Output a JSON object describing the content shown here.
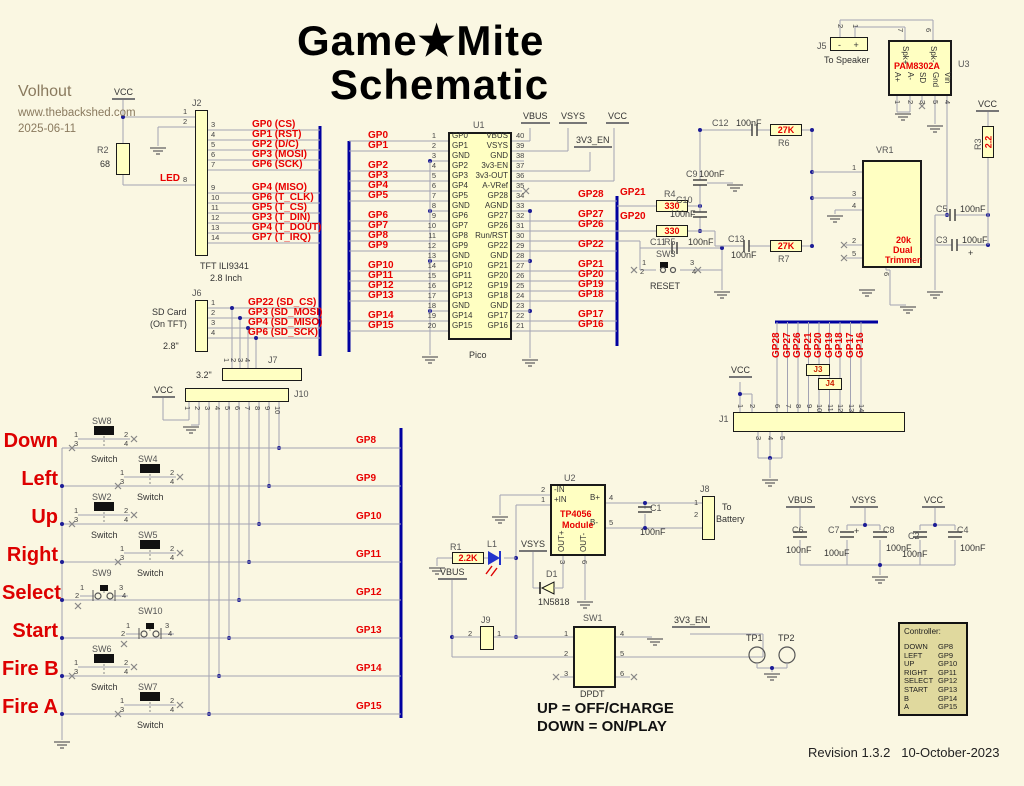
{
  "header": {
    "title_line1": "Game★Mite",
    "title_line2": "Schematic",
    "author": "Volhout",
    "website": "www.thebackshed.com",
    "date": "2025-06-11",
    "revision": "Revision 1.3.2   10-October-2023"
  },
  "notes": {
    "up": "UP = OFF/CHARGE",
    "down": "DOWN = ON/PLAY"
  },
  "controller": {
    "title": "Controller:",
    "rows": [
      {
        "button": "DOWN",
        "gpio": "GP8"
      },
      {
        "button": "LEFT",
        "gpio": "GP9"
      },
      {
        "button": "UP",
        "gpio": "GP10"
      },
      {
        "button": "RIGHT",
        "gpio": "GP11"
      },
      {
        "button": "SELECT",
        "gpio": "GP12"
      },
      {
        "button": "START",
        "gpio": "GP13"
      },
      {
        "button": "B",
        "gpio": "GP14"
      },
      {
        "button": "A",
        "gpio": "GP15"
      }
    ]
  },
  "pico": {
    "ref": "U1",
    "caption": "Pico",
    "left": [
      "GP0",
      "GP1",
      "GND",
      "GP2",
      "GP3",
      "GP4",
      "GP5",
      "GND",
      "GP6",
      "GP7",
      "GP8",
      "GP9",
      "GND",
      "GP10",
      "GP11",
      "GP12",
      "GP13",
      "GND",
      "GP14",
      "GP15"
    ],
    "right": [
      "VBUS",
      "VSYS",
      "GND",
      "3v3-EN",
      "3v3-OUT",
      "A-VRef",
      "GP28",
      "AGND",
      "GP27",
      "GP26",
      "Run/RST",
      "GP22",
      "GND",
      "GP21",
      "GP20",
      "GP19",
      "GP18",
      "GND",
      "GP17",
      "GP16"
    ],
    "nets_left": [
      {
        "p": 1,
        "t": "GP0"
      },
      {
        "p": 2,
        "t": "GP1"
      },
      {
        "p": 4,
        "t": "GP2"
      },
      {
        "p": 5,
        "t": "GP3"
      },
      {
        "p": 6,
        "t": "GP4"
      },
      {
        "p": 7,
        "t": "GP5"
      },
      {
        "p": 9,
        "t": "GP6"
      },
      {
        "p": 10,
        "t": "GP7"
      },
      {
        "p": 11,
        "t": "GP8"
      },
      {
        "p": 12,
        "t": "GP9"
      },
      {
        "p": 14,
        "t": "GP10"
      },
      {
        "p": 15,
        "t": "GP11"
      },
      {
        "p": 16,
        "t": "GP12"
      },
      {
        "p": 17,
        "t": "GP13"
      },
      {
        "p": 19,
        "t": "GP14"
      },
      {
        "p": 20,
        "t": "GP15"
      }
    ],
    "nets_right": [
      {
        "p": 34,
        "t": "GP28"
      },
      {
        "p": 32,
        "t": "GP27"
      },
      {
        "p": 31,
        "t": "GP26"
      },
      {
        "p": 29,
        "t": "GP22"
      },
      {
        "p": 27,
        "t": "GP21"
      },
      {
        "p": 26,
        "t": "GP20"
      },
      {
        "p": 25,
        "t": "GP19"
      },
      {
        "p": 24,
        "t": "GP18"
      },
      {
        "p": 22,
        "t": "GP17"
      },
      {
        "p": 21,
        "t": "GP16"
      }
    ]
  },
  "j2": {
    "ref": "J2",
    "pins_left": [
      {
        "t": "1",
        "y": 117
      },
      {
        "t": "2",
        "y": 127
      },
      {
        "t": "8",
        "y": 185
      }
    ],
    "pins": [
      {
        "n": "3",
        "net": "GP0 (CS)",
        "y": 130
      },
      {
        "n": "4",
        "net": "GP1 (RST)",
        "y": 140
      },
      {
        "n": "5",
        "net": "GP2 (D/C)",
        "y": 150
      },
      {
        "n": "6",
        "net": "GP3 (MOSI)",
        "y": 160
      },
      {
        "n": "7",
        "net": "GP6 (SCK)",
        "y": 170
      },
      {
        "n": "9",
        "net": "GP4 (MISO)",
        "y": 193
      },
      {
        "n": "10",
        "net": "GP6 (T_CLK)",
        "y": 203
      },
      {
        "n": "11",
        "net": "GP5 (T_CS)",
        "y": 213
      },
      {
        "n": "12",
        "net": "GP3 (T_DIN)",
        "y": 223
      },
      {
        "n": "13",
        "net": "GP4 (T_DOUT)",
        "y": 233
      },
      {
        "n": "14",
        "net": "GP7 (T_IRQ)",
        "y": 243
      }
    ]
  },
  "j6": {
    "ref": "J6",
    "pins": [
      {
        "n": "1",
        "net": "GP22 (SD_CS)",
        "y": 308
      },
      {
        "n": "2",
        "net": "GP3 (SD_MOSI)",
        "y": 318
      },
      {
        "n": "3",
        "net": "GP4 (SD_MISO)",
        "y": 328
      },
      {
        "n": "4",
        "net": "GP6 (SD_SCK)",
        "y": 338
      }
    ]
  },
  "j7": {
    "ref": "J7",
    "pins": [
      "1",
      "2",
      "3",
      "4"
    ]
  },
  "j10": {
    "ref": "J10",
    "pins": [
      "1",
      "2",
      "3",
      "4",
      "5",
      "6",
      "7",
      "8",
      "9",
      "10"
    ]
  },
  "buttons": {
    "pin_numbers": [
      "1",
      "2",
      "3",
      "4"
    ],
    "caption": "Switch",
    "rows": [
      {
        "label": "Down",
        "sw": "SW8",
        "net": "GP8",
        "type": "A",
        "cx": 104,
        "row": 448
      },
      {
        "label": "Left",
        "sw": "SW4",
        "net": "GP9",
        "type": "A",
        "cx": 150,
        "row": 486
      },
      {
        "label": "Up",
        "sw": "SW2",
        "net": "GP10",
        "type": "A",
        "cx": 104,
        "row": 524
      },
      {
        "label": "Right",
        "sw": "SW5",
        "net": "GP11",
        "type": "A",
        "cx": 150,
        "row": 562
      },
      {
        "label": "Select",
        "sw": "SW9",
        "net": "GP12",
        "type": "B",
        "cx": 104,
        "row": 600
      },
      {
        "label": "Start",
        "sw": "SW10",
        "net": "GP13",
        "type": "B",
        "cx": 150,
        "row": 638
      },
      {
        "label": "Fire B",
        "sw": "SW6",
        "net": "GP14",
        "type": "A",
        "cx": 104,
        "row": 676
      },
      {
        "label": "Fire A",
        "sw": "SW7",
        "net": "GP15",
        "type": "A",
        "cx": 150,
        "row": 714
      }
    ]
  },
  "j1": {
    "ref": "J1",
    "nets": [
      "GP28",
      "GP27",
      "GP26",
      "GP21",
      "GP20",
      "GP19",
      "GP18",
      "GP17",
      "GP16"
    ],
    "top_pins": [
      "6",
      "7",
      "8",
      "9",
      "10",
      "11",
      "12",
      "13",
      "14"
    ],
    "left_pins": [
      "1",
      "2"
    ],
    "bottom_pins": [
      "3",
      "4",
      "5"
    ],
    "jumpers": [
      "J3",
      "J4"
    ]
  },
  "u2": {
    "ref": "U2",
    "part1": "TP4056",
    "part2": "Module",
    "left": [
      {
        "t": "-IN",
        "n": "2",
        "y": 495
      },
      {
        "t": "+IN",
        "n": "1",
        "y": 505
      }
    ],
    "right": [
      {
        "t": "B+",
        "n": "4",
        "y": 503
      },
      {
        "t": "B-",
        "n": "5",
        "y": 528
      }
    ],
    "bottom": [
      {
        "t": "OUT+",
        "n": "3",
        "x": 563
      },
      {
        "t": "OUT-",
        "n": "6",
        "x": 585
      }
    ]
  },
  "u3": {
    "ref": "U3",
    "part": "PAM8302A",
    "top": [
      {
        "t": "Spk+",
        "n": "7",
        "x": 905
      },
      {
        "t": "Spk-",
        "n": "6",
        "x": 933
      }
    ],
    "bottom": [
      {
        "t": "A+",
        "n": "1",
        "x": 897
      },
      {
        "t": "A-",
        "n": "2",
        "x": 910
      },
      {
        "t": "SD",
        "n": "3",
        "x": 922
      },
      {
        "t": "Gnd",
        "n": "5",
        "x": 935
      },
      {
        "t": "Vin",
        "n": "4",
        "x": 947
      }
    ]
  },
  "sw1": {
    "ref": "SW1",
    "left": [
      "1",
      "2",
      "3"
    ],
    "right": [
      "4",
      "5",
      "6"
    ],
    "caption": "DPDT"
  },
  "resistors": [
    {
      "name": "r2-body",
      "x": 116,
      "y": 143,
      "w": 14,
      "h": 32,
      "val": ""
    },
    {
      "name": "r4-body",
      "x": 656,
      "y": 200,
      "w": 32,
      "h": 12,
      "val": "330"
    },
    {
      "name": "r5-body",
      "x": 656,
      "y": 225,
      "w": 32,
      "h": 12,
      "val": "330"
    },
    {
      "name": "r6-body",
      "x": 770,
      "y": 124,
      "w": 32,
      "h": 12,
      "val": "27K"
    },
    {
      "name": "r7-body",
      "x": 770,
      "y": 240,
      "w": 32,
      "h": 12,
      "val": "27K"
    },
    {
      "name": "r1-body",
      "x": 452,
      "y": 552,
      "w": 32,
      "h": 12,
      "val": "2.2K"
    },
    {
      "name": "r3-body",
      "x": 982,
      "y": 126,
      "w": 12,
      "h": 32,
      "val": "2.2",
      "vert": true
    }
  ],
  "labels": [
    {
      "n": "vcc-tft",
      "t": "VCC",
      "c": "pwr",
      "x": 112,
      "y": 88
    },
    {
      "n": "r2-ref",
      "t": "R2",
      "c": "des",
      "x": 97,
      "y": 146
    },
    {
      "n": "r2-val",
      "t": "68",
      "c": "val",
      "x": 100,
      "y": 160
    },
    {
      "n": "led-net",
      "t": "LED",
      "c": "net",
      "x": 160,
      "y": 174
    },
    {
      "n": "j2-ref",
      "t": "J2",
      "c": "des",
      "x": 192,
      "y": 99
    },
    {
      "n": "tft-cap1",
      "t": "TFT ILI9341",
      "c": "cap",
      "x": 200,
      "y": 262
    },
    {
      "n": "tft-cap2",
      "t": "2.8 Inch",
      "c": "cap",
      "x": 210,
      "y": 274
    },
    {
      "n": "j6-ref",
      "t": "J6",
      "c": "des",
      "x": 192,
      "y": 289
    },
    {
      "n": "sd-cap1",
      "t": "SD Card",
      "c": "cap",
      "x": 152,
      "y": 308
    },
    {
      "n": "sd-cap2",
      "t": "(On TFT)",
      "c": "cap",
      "x": 150,
      "y": 320
    },
    {
      "n": "sd-size1",
      "t": "2.8\"",
      "c": "cap",
      "x": 163,
      "y": 342
    },
    {
      "n": "sd-size2",
      "t": "3.2\"",
      "c": "cap",
      "x": 196,
      "y": 371
    },
    {
      "n": "j7-ref",
      "t": "J7",
      "c": "des",
      "x": 268,
      "y": 356
    },
    {
      "n": "j10-ref",
      "t": "J10",
      "c": "des",
      "x": 294,
      "y": 390
    },
    {
      "n": "vcc-j10",
      "t": "VCC",
      "c": "pwr",
      "x": 152,
      "y": 386
    },
    {
      "n": "u1-ref",
      "t": "U1",
      "c": "des",
      "x": 473,
      "y": 121
    },
    {
      "n": "u1-cap",
      "t": "Pico",
      "c": "cap",
      "x": 469,
      "y": 351
    },
    {
      "n": "vbus-pico",
      "t": "VBUS",
      "c": "pwr",
      "x": 521,
      "y": 112
    },
    {
      "n": "vsys-pico",
      "t": "VSYS",
      "c": "pwr",
      "x": 559,
      "y": 112
    },
    {
      "n": "vcc-pico",
      "t": "VCC",
      "c": "pwr",
      "x": 606,
      "y": 112
    },
    {
      "n": "en-pico",
      "t": "3V3_EN",
      "c": "pwr",
      "x": 574,
      "y": 136
    },
    {
      "n": "gp21-net",
      "t": "GP21",
      "c": "net",
      "x": 620,
      "y": 188
    },
    {
      "n": "gp20-net",
      "t": "GP20",
      "c": "net",
      "x": 620,
      "y": 212
    },
    {
      "n": "r4-ref",
      "t": "R4",
      "c": "des",
      "x": 664,
      "y": 190
    },
    {
      "n": "r5-ref",
      "t": "R5",
      "c": "des",
      "x": 664,
      "y": 238
    },
    {
      "n": "c9-ref",
      "t": "C9",
      "c": "des",
      "x": 686,
      "y": 170
    },
    {
      "n": "c9-val",
      "t": "100nF",
      "c": "val",
      "x": 699,
      "y": 170
    },
    {
      "n": "c10-ref",
      "t": "C10",
      "c": "des",
      "x": 676,
      "y": 196
    },
    {
      "n": "c10-val",
      "t": "100nF",
      "c": "val",
      "x": 670,
      "y": 210
    },
    {
      "n": "c12-ref",
      "t": "C12",
      "c": "des",
      "x": 712,
      "y": 119
    },
    {
      "n": "c12-val",
      "t": "100nF",
      "c": "val",
      "x": 736,
      "y": 119
    },
    {
      "n": "r6-ref",
      "t": "R6",
      "c": "des",
      "x": 778,
      "y": 139
    },
    {
      "n": "c13-ref",
      "t": "C13",
      "c": "des",
      "x": 728,
      "y": 235
    },
    {
      "n": "c13-val",
      "t": "100nF",
      "c": "val",
      "x": 731,
      "y": 251
    },
    {
      "n": "r7-ref",
      "t": "R7",
      "c": "des",
      "x": 778,
      "y": 255
    },
    {
      "n": "c11-ref",
      "t": "C11",
      "c": "des",
      "x": 650,
      "y": 238
    },
    {
      "n": "c11-val",
      "t": "100nF",
      "c": "val",
      "x": 688,
      "y": 238
    },
    {
      "n": "sw3-ref",
      "t": "SW3",
      "c": "des",
      "x": 656,
      "y": 250
    },
    {
      "n": "sw3-p1",
      "t": "1",
      "c": "pin",
      "x": 642,
      "y": 259
    },
    {
      "n": "sw3-p2",
      "t": "2",
      "c": "pin",
      "x": 640,
      "y": 268
    },
    {
      "n": "sw3-p3",
      "t": "3",
      "c": "pin",
      "x": 690,
      "y": 259
    },
    {
      "n": "sw3-p4",
      "t": "4",
      "c": "pin",
      "x": 692,
      "y": 268
    },
    {
      "n": "sw3-cap",
      "t": "RESET",
      "c": "cap",
      "x": 650,
      "y": 282
    },
    {
      "n": "vr1-ref",
      "t": "VR1",
      "c": "des",
      "x": 876,
      "y": 146
    },
    {
      "n": "vr1-p1",
      "t": "1",
      "c": "pin",
      "x": 852,
      "y": 164
    },
    {
      "n": "vr1-p3",
      "t": "3",
      "c": "pin",
      "x": 852,
      "y": 190
    },
    {
      "n": "vr1-p4",
      "t": "4",
      "c": "pin",
      "x": 852,
      "y": 202
    },
    {
      "n": "vr1-p2",
      "t": "2",
      "c": "pin",
      "x": 852,
      "y": 237
    },
    {
      "n": "vr1-p5",
      "t": "5",
      "c": "pin",
      "x": 852,
      "y": 250
    },
    {
      "n": "vr1-p6",
      "t": "6",
      "c": "pin",
      "x": 890,
      "y": 272,
      "r": 90
    },
    {
      "n": "vr1-val1",
      "t": "20k",
      "c": "rlbl",
      "x": 896,
      "y": 236
    },
    {
      "n": "vr1-val2",
      "t": "Dual",
      "c": "rlbl",
      "x": 893,
      "y": 246
    },
    {
      "n": "vr1-val3",
      "t": "Trimmer",
      "c": "rlbl",
      "x": 885,
      "y": 256
    },
    {
      "n": "j5-ref",
      "t": "J5",
      "c": "des",
      "x": 817,
      "y": 42
    },
    {
      "n": "j5-pol",
      "t": "-     +",
      "c": "val",
      "x": 838,
      "y": 41
    },
    {
      "n": "j5-p2",
      "t": "2",
      "c": "pin",
      "x": 844,
      "y": 24,
      "r": 90
    },
    {
      "n": "j5-p1",
      "t": "1",
      "c": "pin",
      "x": 859,
      "y": 24,
      "r": 90
    },
    {
      "n": "j5-cap",
      "t": "To Speaker",
      "c": "cap",
      "x": 824,
      "y": 56
    },
    {
      "n": "u3-ref",
      "t": "U3",
      "c": "des",
      "x": 958,
      "y": 60
    },
    {
      "n": "u3-part",
      "t": "PAM8302A",
      "c": "rlbl",
      "x": 894,
      "y": 62
    },
    {
      "n": "vcc-r3",
      "t": "VCC",
      "c": "pwr",
      "x": 976,
      "y": 100
    },
    {
      "n": "r3-ref",
      "t": "R3",
      "c": "des",
      "x": 974,
      "y": 150,
      "r": -90
    },
    {
      "n": "c5-ref",
      "t": "C5",
      "c": "des",
      "x": 936,
      "y": 205
    },
    {
      "n": "c5-val",
      "t": "100nF",
      "c": "val",
      "x": 960,
      "y": 205
    },
    {
      "n": "c3-ref",
      "t": "C3",
      "c": "des",
      "x": 936,
      "y": 236
    },
    {
      "n": "c3-val",
      "t": "100uF",
      "c": "val",
      "x": 962,
      "y": 236
    },
    {
      "n": "c3-plus",
      "t": "+",
      "c": "val",
      "x": 968,
      "y": 249
    },
    {
      "n": "u2-ref",
      "t": "U2",
      "c": "des",
      "x": 564,
      "y": 474
    },
    {
      "n": "c1-ref",
      "t": "C1",
      "c": "des",
      "x": 650,
      "y": 504
    },
    {
      "n": "c1-val",
      "t": "100nF",
      "c": "val",
      "x": 640,
      "y": 528
    },
    {
      "n": "j8-ref",
      "t": "J8",
      "c": "des",
      "x": 700,
      "y": 485
    },
    {
      "n": "j8-p1",
      "t": "1",
      "c": "pin",
      "x": 694,
      "y": 499
    },
    {
      "n": "j8-p2",
      "t": "2",
      "c": "pin",
      "x": 694,
      "y": 511
    },
    {
      "n": "j8-cap1",
      "t": "To",
      "c": "cap",
      "x": 722,
      "y": 503
    },
    {
      "n": "j8-cap2",
      "t": "Battery",
      "c": "cap",
      "x": 716,
      "y": 515
    },
    {
      "n": "r1-ref",
      "t": "R1",
      "c": "des",
      "x": 450,
      "y": 543
    },
    {
      "n": "l1-ref",
      "t": "L1",
      "c": "des",
      "x": 487,
      "y": 540
    },
    {
      "n": "vsys-d1",
      "t": "VSYS",
      "c": "pwr",
      "x": 519,
      "y": 540
    },
    {
      "n": "d1-ref",
      "t": "D1",
      "c": "des",
      "x": 546,
      "y": 570
    },
    {
      "n": "d1-val",
      "t": "1N5818",
      "c": "cap",
      "x": 538,
      "y": 598
    },
    {
      "n": "vbus-l",
      "t": "VBUS",
      "c": "pwr",
      "x": 438,
      "y": 568
    },
    {
      "n": "j9-ref",
      "t": "J9",
      "c": "des",
      "x": 481,
      "y": 616
    },
    {
      "n": "j9-p2",
      "t": "2",
      "c": "pin",
      "x": 468,
      "y": 630
    },
    {
      "n": "j9-p1",
      "t": "1",
      "c": "pin",
      "x": 497,
      "y": 630
    },
    {
      "n": "sw1-ref",
      "t": "SW1",
      "c": "des",
      "x": 583,
      "y": 614
    },
    {
      "n": "sw1-cap",
      "t": "DPDT",
      "c": "cap",
      "x": 580,
      "y": 690
    },
    {
      "n": "en-sw1",
      "t": "3V3_EN",
      "c": "pwr",
      "x": 672,
      "y": 616
    },
    {
      "n": "vcc-j1",
      "t": "VCC",
      "c": "pwr",
      "x": 729,
      "y": 366
    },
    {
      "n": "j1-ref",
      "t": "J1",
      "c": "des",
      "x": 719,
      "y": 415
    },
    {
      "n": "vbus-cb",
      "t": "VBUS",
      "c": "pwr",
      "x": 786,
      "y": 496
    },
    {
      "n": "vsys-cb",
      "t": "VSYS",
      "c": "pwr",
      "x": 850,
      "y": 496
    },
    {
      "n": "vcc-cb",
      "t": "VCC",
      "c": "pwr",
      "x": 922,
      "y": 496
    },
    {
      "n": "c6-ref",
      "t": "C6",
      "c": "des",
      "x": 792,
      "y": 526
    },
    {
      "n": "c6-val",
      "t": "100nF",
      "c": "val",
      "x": 786,
      "y": 546
    },
    {
      "n": "c7-ref",
      "t": "C7",
      "c": "des",
      "x": 828,
      "y": 526
    },
    {
      "n": "c7-plus",
      "t": "+",
      "c": "val",
      "x": 854,
      "y": 527
    },
    {
      "n": "c7-val",
      "t": "100uF",
      "c": "val",
      "x": 824,
      "y": 549
    },
    {
      "n": "c8-ref",
      "t": "C8",
      "c": "des",
      "x": 883,
      "y": 526
    },
    {
      "n": "c8-val",
      "t": "100nF",
      "c": "val",
      "x": 886,
      "y": 544
    },
    {
      "n": "c2-ref",
      "t": "C2",
      "c": "des",
      "x": 908,
      "y": 532
    },
    {
      "n": "c2-val",
      "t": "100nF",
      "c": "val",
      "x": 902,
      "y": 550
    },
    {
      "n": "c4-ref",
      "t": "C4",
      "c": "des",
      "x": 957,
      "y": 526
    },
    {
      "n": "c4-val",
      "t": "100nF",
      "c": "val",
      "x": 960,
      "y": 544
    },
    {
      "n": "tp1-ref",
      "t": "TP1",
      "c": "cap",
      "x": 746,
      "y": 634
    },
    {
      "n": "tp2-ref",
      "t": "TP2",
      "c": "cap",
      "x": 778,
      "y": 634
    }
  ]
}
